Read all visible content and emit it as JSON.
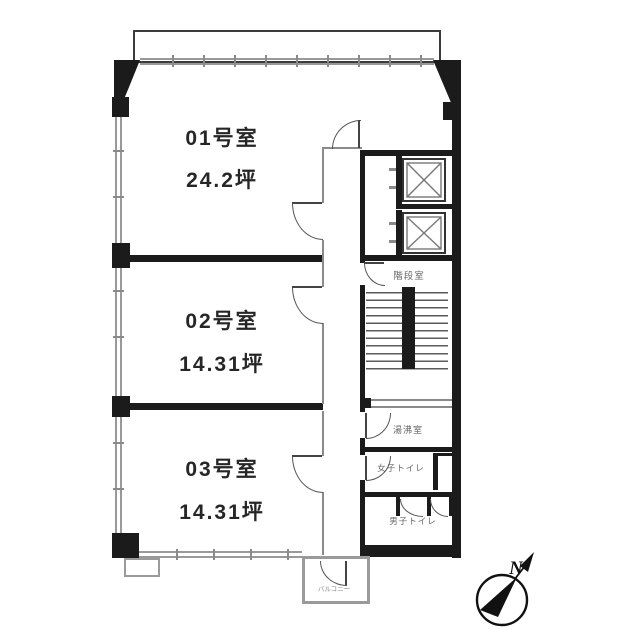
{
  "plan": {
    "rooms": [
      {
        "name": "01号室",
        "area": "24.2坪"
      },
      {
        "name": "02号室",
        "area": "14.31坪"
      },
      {
        "name": "03号室",
        "area": "14.31坪"
      }
    ],
    "facilities": {
      "stairwell": "階段室",
      "kitchenette": "湯沸室",
      "womens_toilet": "女子トイレ",
      "mens_toilet": "男子トイレ",
      "balcony": "バルコニー"
    },
    "compass": {
      "north": "N"
    },
    "colors": {
      "wall": "#1b1b1b",
      "window": "#999999",
      "door": "#555555",
      "text": "#262626"
    }
  }
}
